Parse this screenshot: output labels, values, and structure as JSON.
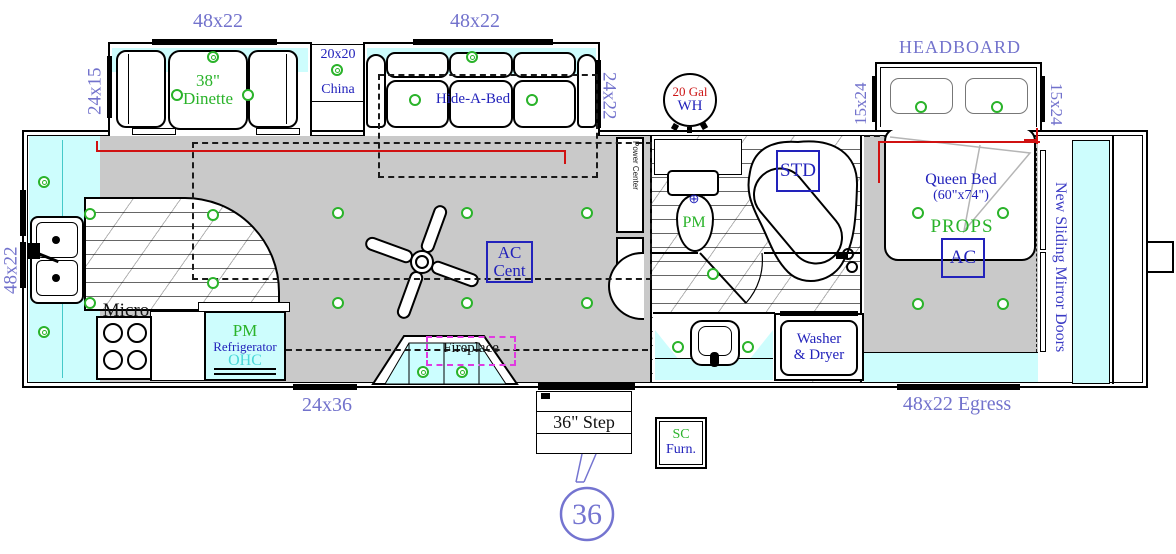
{
  "colors": {
    "dimension_label_purple": "#7272cc",
    "feature_label_blue": "#2222bb",
    "fixture_label_green": "#2ab32a",
    "water_heater_red": "#cc1515",
    "ohc_cyan": "#4ad8d8",
    "slide_highlight_cyan": "#cdfdfd",
    "floor_gray": "#c9c9c9",
    "fireplace_outline_magenta": "#e03ae0",
    "slide_seal_red": "#d01111"
  },
  "slides": {
    "dinette": {
      "top_label": "48x22",
      "side_label": "24x15",
      "table_line1": "38\"",
      "table_line2": "Dinette"
    },
    "china": {
      "size": "20x20",
      "name": "China"
    },
    "sofa": {
      "top_label": "48x22",
      "side_label": "24x22",
      "name": "Hide-A-Bed"
    },
    "headboard": {
      "label": "HEADBOARD",
      "left_label": "15x24",
      "right_label": "15x24"
    }
  },
  "water_heater": {
    "line1": "20 Gal",
    "line2": "WH"
  },
  "kitchen": {
    "window_label": "48x22",
    "micro_label": "Micro",
    "fridge_line1": "PM",
    "fridge_line2": "Refrigerator",
    "fridge_line3": "OHC"
  },
  "living": {
    "ac_line1": "AC",
    "ac_line2": "Cent",
    "fireplace_label": "Fireplace",
    "window_label": "24x36"
  },
  "bath": {
    "power_center": "Power Center",
    "toilet_label": "PM",
    "toilet_symbol": "⊕",
    "tub_label": "STD",
    "washer_line1": "Washer",
    "washer_line2": "& Dryer"
  },
  "bedroom": {
    "bed_line1": "Queen Bed",
    "bed_line2": "(60\"x74\")",
    "props_label": "PROPS",
    "ac_label": "AC",
    "egress_label": "48x22 Egress",
    "mirror_doors_label": "New Sliding Mirror Doors"
  },
  "entry": {
    "step_label": "36\" Step",
    "length_badge": "36",
    "sc_line1": "SC",
    "sc_line2": "Furn."
  },
  "lights": [
    {
      "x": 90,
      "y": 214,
      "d": false
    },
    {
      "x": 90,
      "y": 303,
      "d": false
    },
    {
      "x": 213,
      "y": 215,
      "d": false
    },
    {
      "x": 213,
      "y": 283,
      "d": false
    },
    {
      "x": 338,
      "y": 213,
      "d": false
    },
    {
      "x": 467,
      "y": 213,
      "d": false
    },
    {
      "x": 587,
      "y": 213,
      "d": false
    },
    {
      "x": 338,
      "y": 303,
      "d": false
    },
    {
      "x": 467,
      "y": 303,
      "d": false
    },
    {
      "x": 587,
      "y": 303,
      "d": false
    },
    {
      "x": 177,
      "y": 95,
      "d": false
    },
    {
      "x": 248,
      "y": 95,
      "d": false
    },
    {
      "x": 415,
      "y": 100,
      "d": false
    },
    {
      "x": 532,
      "y": 100,
      "d": false
    },
    {
      "x": 713,
      "y": 274,
      "d": false
    },
    {
      "x": 678,
      "y": 347,
      "d": false
    },
    {
      "x": 748,
      "y": 347,
      "d": false
    },
    {
      "x": 918,
      "y": 213,
      "d": false
    },
    {
      "x": 1003,
      "y": 213,
      "d": false
    },
    {
      "x": 918,
      "y": 304,
      "d": false
    },
    {
      "x": 1003,
      "y": 304,
      "d": false
    },
    {
      "x": 921,
      "y": 107,
      "d": false
    },
    {
      "x": 997,
      "y": 107,
      "d": false
    },
    {
      "x": 44,
      "y": 182,
      "d": true
    },
    {
      "x": 44,
      "y": 332,
      "d": true
    },
    {
      "x": 213,
      "y": 57,
      "d": true
    },
    {
      "x": 337,
      "y": 70,
      "d": true
    },
    {
      "x": 472,
      "y": 57,
      "d": true
    },
    {
      "x": 423,
      "y": 372,
      "d": true
    },
    {
      "x": 462,
      "y": 372,
      "d": true
    }
  ]
}
